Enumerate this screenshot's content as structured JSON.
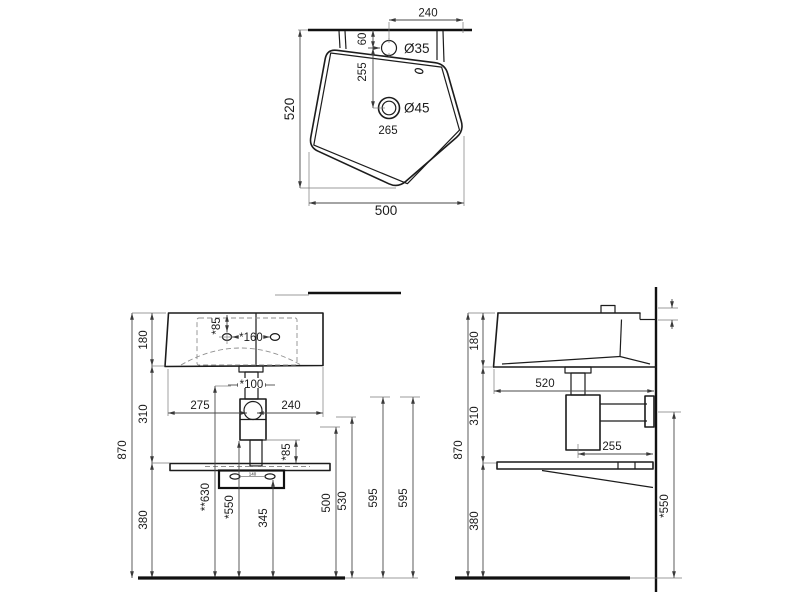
{
  "meta": {
    "background": "#ffffff",
    "object_line_color": "#1c1c1c",
    "dimension_line_color": "#4a4a4a"
  },
  "top_view": {
    "wall_span": "240",
    "tap_from_wall": "60",
    "tap_hole_dia": "Ø35",
    "tap_to_drain": "255",
    "drain_dia": "Ø45",
    "drain_label": "265",
    "depth": "520",
    "width": "500"
  },
  "front_view": {
    "rim_to_bottom": "180",
    "total_height": "870",
    "bottom_to_shelf": "310",
    "shelf_to_floor": "380",
    "tap_from_rim": "*85",
    "tap_spacing": "*160",
    "left_to_trap": "275",
    "trap_to_right": "240",
    "waste_dia": "*100",
    "waste_height": "**630",
    "trap_height": "*550",
    "bolt_height": "345",
    "shelf_clearance": "*85",
    "h500": "500",
    "h530": "530",
    "h595_left": "595",
    "h595_right": "595",
    "bracket_spacing": "140"
  },
  "side_view": {
    "rim_to_bottom": "180",
    "total_height": "870",
    "bottom_to_shelf": "310",
    "shelf_to_floor": "380",
    "depth": "520",
    "drain_to_wall": "255",
    "outlet_height": "*550"
  }
}
